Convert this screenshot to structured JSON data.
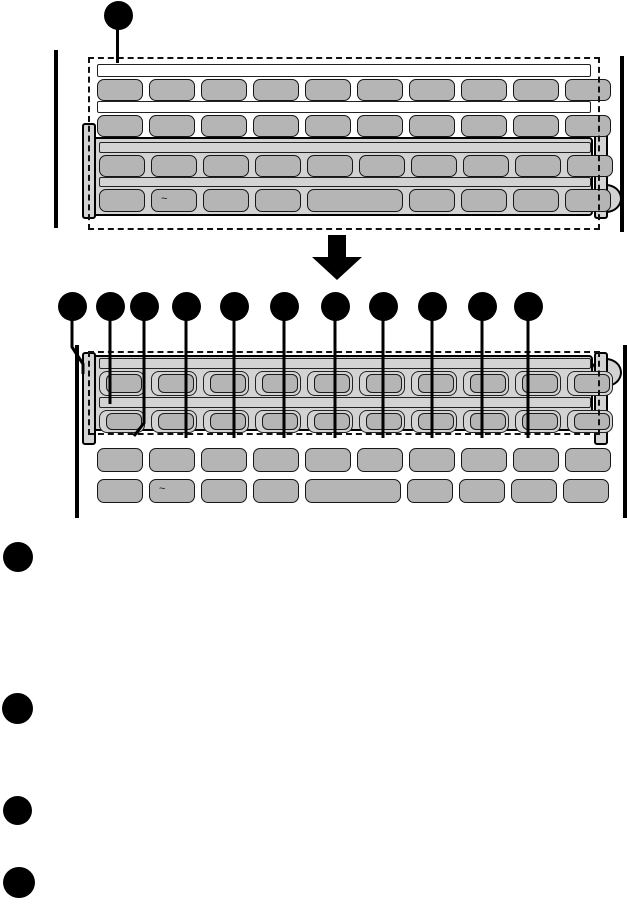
{
  "colors": {
    "outline": "#111111",
    "key_fill": "#b5b5b5",
    "cover_fill": "#d3d3d3",
    "strip_fill": "#ffffff",
    "callout_fill": "#000000"
  },
  "figure_top": {
    "callout_count": 1,
    "tilde_label": "~",
    "rows": [
      {
        "kind": "strip"
      },
      {
        "kind": "keys",
        "count": 10
      },
      {
        "kind": "strip"
      },
      {
        "kind": "keys",
        "count": 10
      },
      {
        "kind": "strip"
      },
      {
        "kind": "keys",
        "count": 10
      },
      {
        "kind": "strip"
      },
      {
        "kind": "keys",
        "count": 9,
        "widths": [
          1,
          1,
          1,
          1,
          2,
          1,
          1,
          1,
          1
        ],
        "tilde_index": 1
      }
    ]
  },
  "transition_arrow": {
    "direction": "down"
  },
  "figure_bottom": {
    "callout_count": 11,
    "tilde_label": "~",
    "rows": [
      {
        "kind": "strip"
      },
      {
        "kind": "keys",
        "count": 10,
        "holes": true
      },
      {
        "kind": "strip"
      },
      {
        "kind": "keys",
        "count": 10,
        "holes": true
      },
      {
        "kind": "keys",
        "count": 10
      },
      {
        "kind": "keys",
        "count": 9,
        "widths": [
          1,
          1,
          1,
          1,
          2,
          1,
          1,
          1,
          1
        ],
        "tilde_index": 1
      }
    ]
  },
  "list_bullet_count": 4
}
